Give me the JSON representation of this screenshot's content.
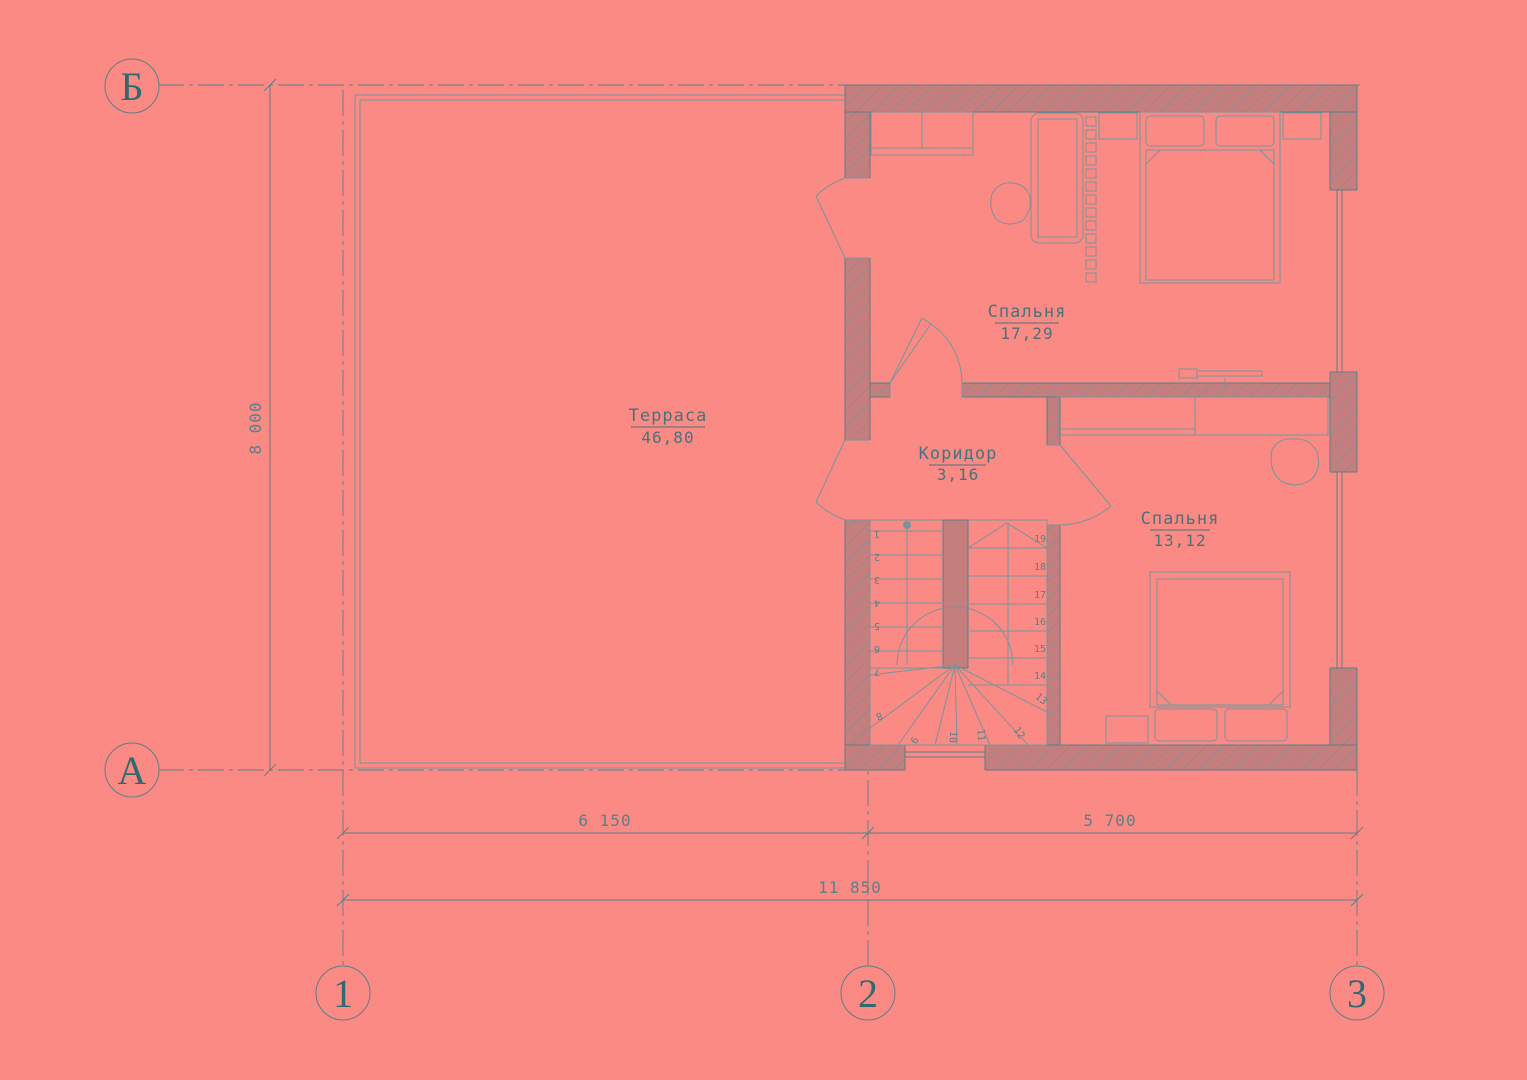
{
  "colors": {
    "background": "#fa8a83",
    "wall_fill": "#c47e7e",
    "hatch_line": "#73909a",
    "main_line": "#5d7f88",
    "thin_line": "#7b949c",
    "label_text": "#49737c",
    "axis_text": "#2f6a72"
  },
  "axis_markers": {
    "row_top": "Б",
    "row_bottom": "А",
    "col_left": "1",
    "col_mid": "2",
    "col_right": "3"
  },
  "dimensions": {
    "horizontal_left": "6 150",
    "horizontal_right": "5 700",
    "horizontal_total": "11 850",
    "vertical_total": "8 000"
  },
  "rooms": {
    "terrace": {
      "name": "Терраса",
      "area": "46,80"
    },
    "bedroom1": {
      "name": "Спальня",
      "area": "17,29"
    },
    "corridor": {
      "name": "Коридор",
      "area": "3,16"
    },
    "bedroom2": {
      "name": "Спальня",
      "area": "13,12"
    }
  },
  "stairs": {
    "treads": [
      "1",
      "2",
      "3",
      "4",
      "5",
      "6",
      "7",
      "8",
      "9",
      "10",
      "11",
      "12",
      "13",
      "14",
      "15",
      "16",
      "17",
      "18",
      "19"
    ]
  }
}
